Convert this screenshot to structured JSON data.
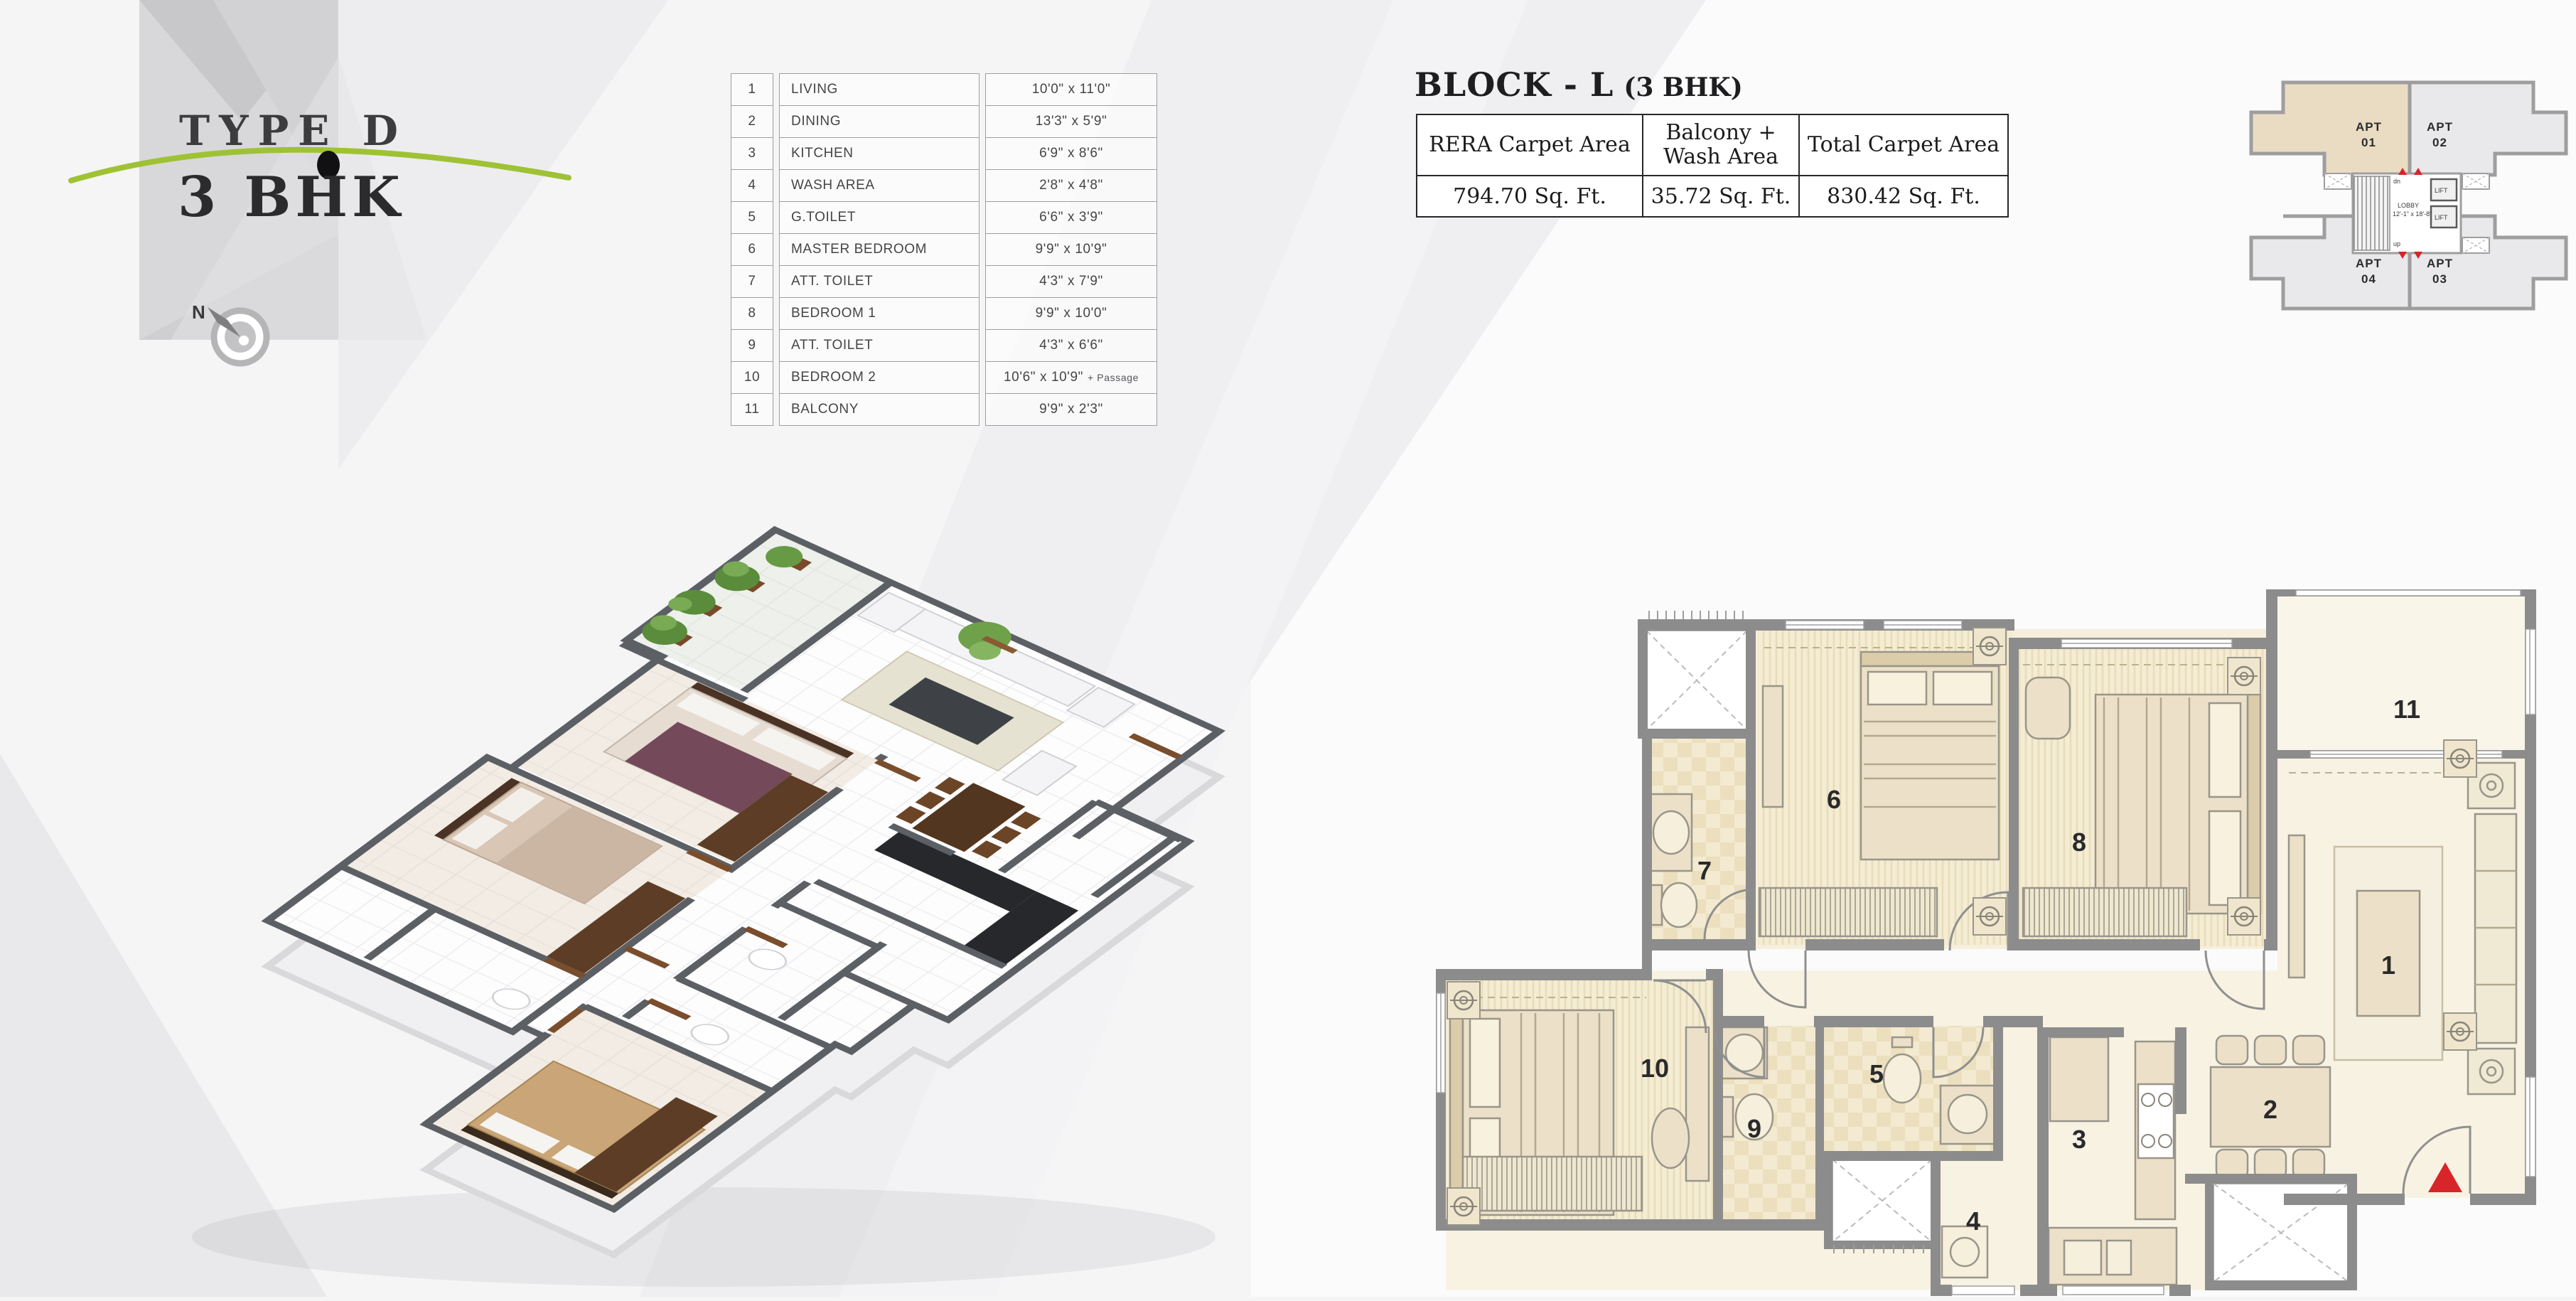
{
  "logo": {
    "type_label": "TYPE D",
    "bhk_label": "3 BHK",
    "north_label": "N"
  },
  "room_table": {
    "rows": [
      {
        "no": "1",
        "name": "LIVING",
        "size": "10'0\" x 11'0\""
      },
      {
        "no": "2",
        "name": "DINING",
        "size": "13'3\" x 5'9\""
      },
      {
        "no": "3",
        "name": "KITCHEN",
        "size": "6'9\" x 8'6\""
      },
      {
        "no": "4",
        "name": "WASH AREA",
        "size": "2'8\" x 4'8\""
      },
      {
        "no": "5",
        "name": "G.TOILET",
        "size": "6'6\" x 3'9\""
      },
      {
        "no": "6",
        "name": "MASTER BEDROOM",
        "size": "9'9\" x 10'9\""
      },
      {
        "no": "7",
        "name": "ATT. TOILET",
        "size": "4'3\" x 7'9\""
      },
      {
        "no": "8",
        "name": "BEDROOM 1",
        "size": "9'9\" x 10'0\""
      },
      {
        "no": "9",
        "name": "ATT. TOILET",
        "size": "4'3\" x 6'6\""
      },
      {
        "no": "10",
        "name": "BEDROOM 2",
        "size": "10'6\" x 10'9\"",
        "suffix": "+ Passage"
      },
      {
        "no": "11",
        "name": "BALCONY",
        "size": "9'9\" x 2'3\""
      }
    ]
  },
  "block_info": {
    "title": "BLOCK - L",
    "subtitle": "(3 BHK)",
    "headers": [
      "RERA Carpet Area",
      "Balcony + Wash Area",
      "Total Carpet Area"
    ],
    "values": [
      "794.70 Sq. Ft.",
      "35.72 Sq. Ft.",
      "830.42 Sq. Ft."
    ]
  },
  "key_plan": {
    "apt_word": "APT",
    "apt_numbers": [
      "01",
      "02",
      "03",
      "04"
    ],
    "lobby_label": "LOBBY",
    "lobby_size": "12'-1\" x 18'-8\"",
    "lift_label": "LIFT",
    "stairs_down": "dn",
    "stairs_up": "up"
  },
  "floor_plan": {
    "labels": [
      "1",
      "2",
      "3",
      "4",
      "5",
      "6",
      "7",
      "8",
      "9",
      "10",
      "11"
    ]
  },
  "colors": {
    "accent_green": "#9fc235",
    "entry_red": "#d8252a",
    "wall_gray": "#8c8c8c",
    "room_cream": "#f6efdc",
    "highlight_beige": "#eadcc3",
    "text_dark": "#2b2b2d"
  }
}
